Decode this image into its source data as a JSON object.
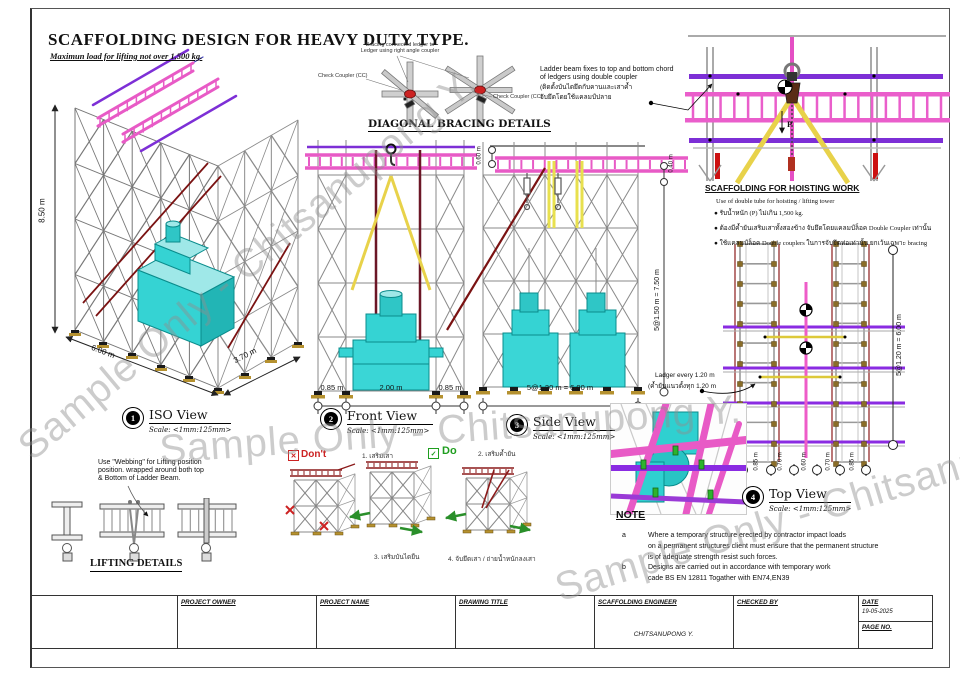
{
  "sheet": {
    "title": "SCAFFOLDING DESIGN FOR HEAVY DUTY  TYPE.",
    "subtitle": "Maximun load for lifting not over 1,500 kg."
  },
  "watermark": {
    "text": "Sample Only - Chitsanupong Y."
  },
  "bracing_detail": {
    "callout_line1": "Bracing connected ledger to",
    "callout_line2": "Ledger using right angle coupler",
    "check_coupler_left": "Check Coupler (CC)",
    "check_coupler_right": "Check Coupler (CC)",
    "heading": "DIAGONAL BRACING DETAILS"
  },
  "ladder_beam_note": {
    "line1": "Ladder beam fixes to top and bottom chord",
    "line2": "of ledgers using double coupler",
    "line3": "(ติดตั้งบันไดยึดกับคานและเสาค้ำ",
    "line4": "จับยึดโดยใช้แคลมป์ปลาย"
  },
  "hoisting": {
    "heading": "SCAFFOLDING FOR HOISTING WORK",
    "subheading": "Use of double tube for hoisting / lifting tower",
    "bullet1": "รับน้ำหนัก (P) ไม่เกิน 1,500 kg.",
    "bullet2": "ต้องมีค้ำยันเสริมเสาทั้งสองข้าง จับยึดโดยแคลมป์ล็อค Double Coupler เท่านั้น",
    "bullet3": "ใช้แคลมป์ล็อค Double couplers ในการจับยึดท่อเท่านั้น ยกเว้นเฉพาะ bracing",
    "load_label": "P"
  },
  "views": {
    "iso": {
      "number": "1",
      "name": "ISO View",
      "scale": "Scale: <1mm:125mm>",
      "dim_height": "8.50 m",
      "dim_width": "6.00 m",
      "dim_depth": "3.70 m"
    },
    "front": {
      "number": "2",
      "name": "Front View",
      "scale": "Scale: <1mm:125mm>",
      "dim_left": "0.85 m",
      "dim_center": "2.00 m",
      "dim_right": "0.85 m"
    },
    "side": {
      "number": "3",
      "name": "Side View",
      "scale": "Scale: <1mm:125mm>",
      "dim_top_left": "0.60 m",
      "dim_top_right": "0.40 m",
      "dim_vertical": "5@1.50 m = 7.50 m",
      "dim_bottom": "5@1.20 m = 6.00 m"
    },
    "top": {
      "number": "4",
      "name": "Top View",
      "scale": "Scale: <1mm:125mm>",
      "dim_vertical": "5@1.20 m = 6.00 m",
      "dims_bottom": [
        "0.85 m",
        "0.70 m",
        "0.60 m",
        "0.70 m",
        "0.85 m"
      ]
    }
  },
  "ladger_note": {
    "line1": "Ladger every 1.20 m",
    "line2": "(ค้ำยันแนวตั้งทุก 1.20 m"
  },
  "lifting": {
    "note_line1": "Use \"Webbing\" for Lifting position",
    "note_line2": "position. wrapped around both top",
    "note_line3": "& Bottom of Ladder Beam.",
    "heading": "LIFTING DETAILS"
  },
  "dont_do": {
    "dont_label": "Don't",
    "do_label": "Do",
    "caption1": "1. เสริมเสา",
    "caption2": "2. เสริมค้ำยัน",
    "caption3": "3. เสริมบันไดยืน",
    "caption4": "4. จับยึดเสา / ถ่ายน้ำหนักลงเสา"
  },
  "notes": {
    "heading": "NOTE",
    "item_a_key": "a",
    "item_a_line1": "Where a temporary structure erected by contractor impact loads",
    "item_a_line2": "on a permanent structures client must ensure that the permanent structure",
    "item_a_line3": "is of adequate strength resist such forces.",
    "item_b_key": "b",
    "item_b_line1": "Designs are carried out in accordance with temporary work",
    "item_b_line2": "cade BS EN 12811 Togather with EN74,EN39"
  },
  "title_block": {
    "project_owner_label": "PROJECT OWNER",
    "project_name_label": "PROJECT NAME",
    "drawing_title_label": "DRAWING TITLE",
    "engineer_label": "SCAFFOLDING ENGINEER",
    "engineer_value": "CHITSANUPONG Y.",
    "checked_by_label": "CHECKED BY",
    "date_label": "DATE",
    "date_value": "19-05-2025",
    "page_label": "PAGE NO."
  },
  "colors": {
    "pink": "#e85ac6",
    "purple": "#7d2fd6",
    "yellow": "#e8d24a",
    "teal": "#35d3d3",
    "dark_red": "#7a1212",
    "red": "#cc2222",
    "green": "#1f9e1f"
  }
}
